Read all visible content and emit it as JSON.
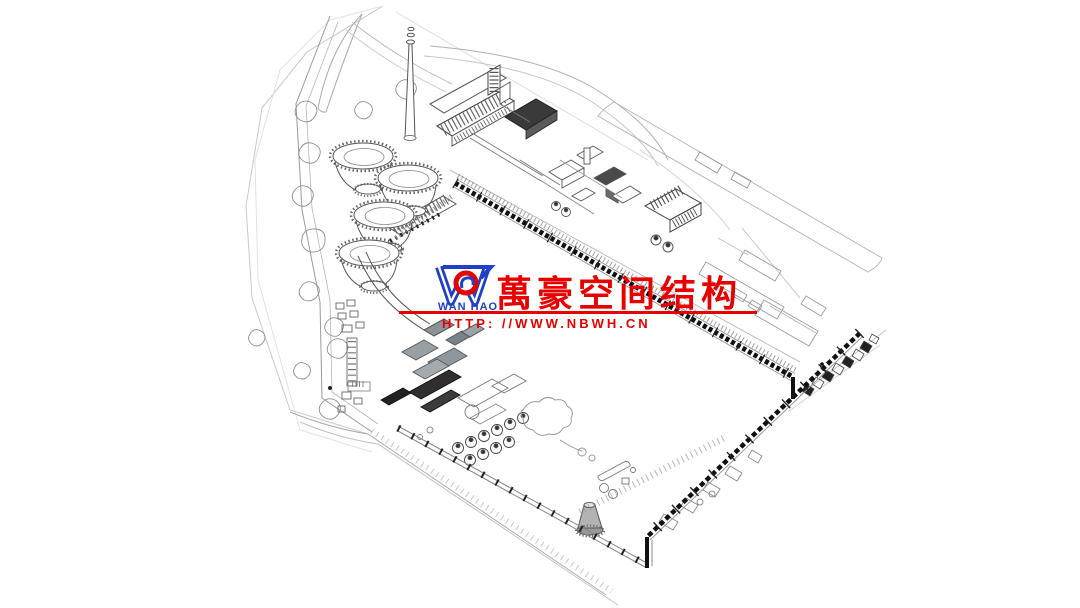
{
  "watermark": {
    "logo_text": "WAN HAO",
    "company_name": "萬豪空间结构",
    "website_url": "HTTP: //WWW.NBWH.CN",
    "colors": {
      "red": "#e80000",
      "blue": "#2140c8"
    }
  },
  "drawing": {
    "background": "#ffffff",
    "line_color": "#555555",
    "depicted": {
      "type": "isometric line-art site plan of an industrial power plant",
      "cooling_tower_count": 4,
      "features": [
        "chimney-stack",
        "cooling-towers",
        "turbine-hall",
        "boiler-house",
        "coal-conveyor-trestle",
        "jetty-trestle",
        "coal-yard-tanks",
        "pond",
        "small-cooling-tower",
        "tree-landscape",
        "site-roads"
      ]
    }
  }
}
